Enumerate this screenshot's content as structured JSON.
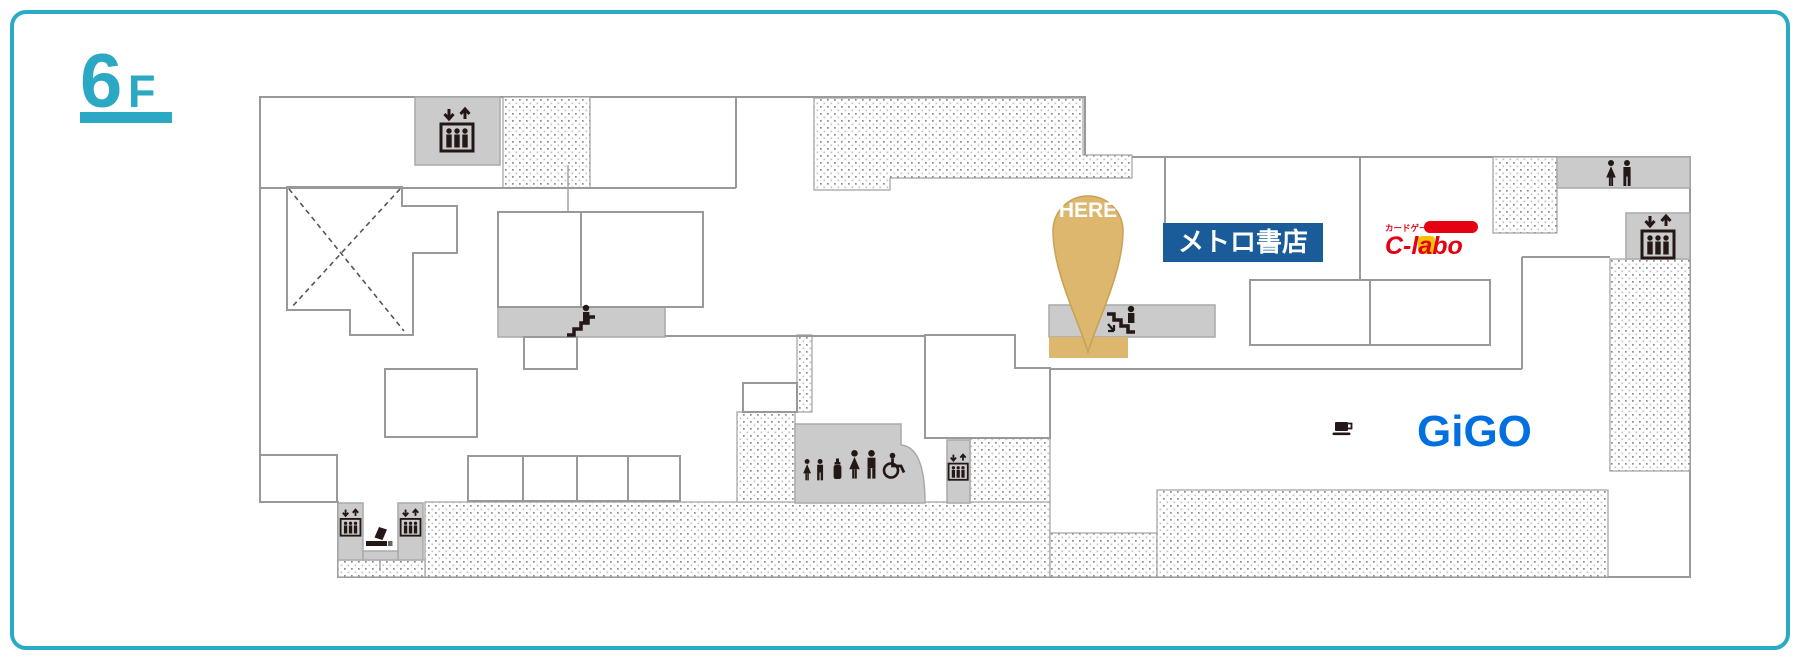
{
  "floor": {
    "label": "6",
    "suffix": "F"
  },
  "marker": {
    "label": "HERE"
  },
  "stores": {
    "metro": {
      "name": "メトロ書店",
      "type": "bookstore"
    },
    "clabo": {
      "name": "C-labo",
      "tagline": "カードゲームショップ",
      "type": "card game shop"
    },
    "gigo": {
      "name": "GiGO",
      "type": "game center"
    }
  },
  "facility_icons": [
    "elevator",
    "escalator-up",
    "escalator-down",
    "restroom-women-men",
    "kids-restroom",
    "nursing-room",
    "accessible-restroom",
    "smoking-area",
    "cafe"
  ],
  "colors": {
    "frame_teal": "#2BAAC6",
    "floor_teal": "#2BA9C4",
    "here_gold": "#DCB76D",
    "here_gold_border": "#C9A055",
    "metro_blue": "#1A5C9A",
    "clabo_red": "#E50012",
    "clabo_yellow": "#F5C400",
    "gigo_blue": "#0070E0",
    "area_gray": "#CBCBCB",
    "wall_gray": "#999999",
    "icon_black": "#231815"
  }
}
